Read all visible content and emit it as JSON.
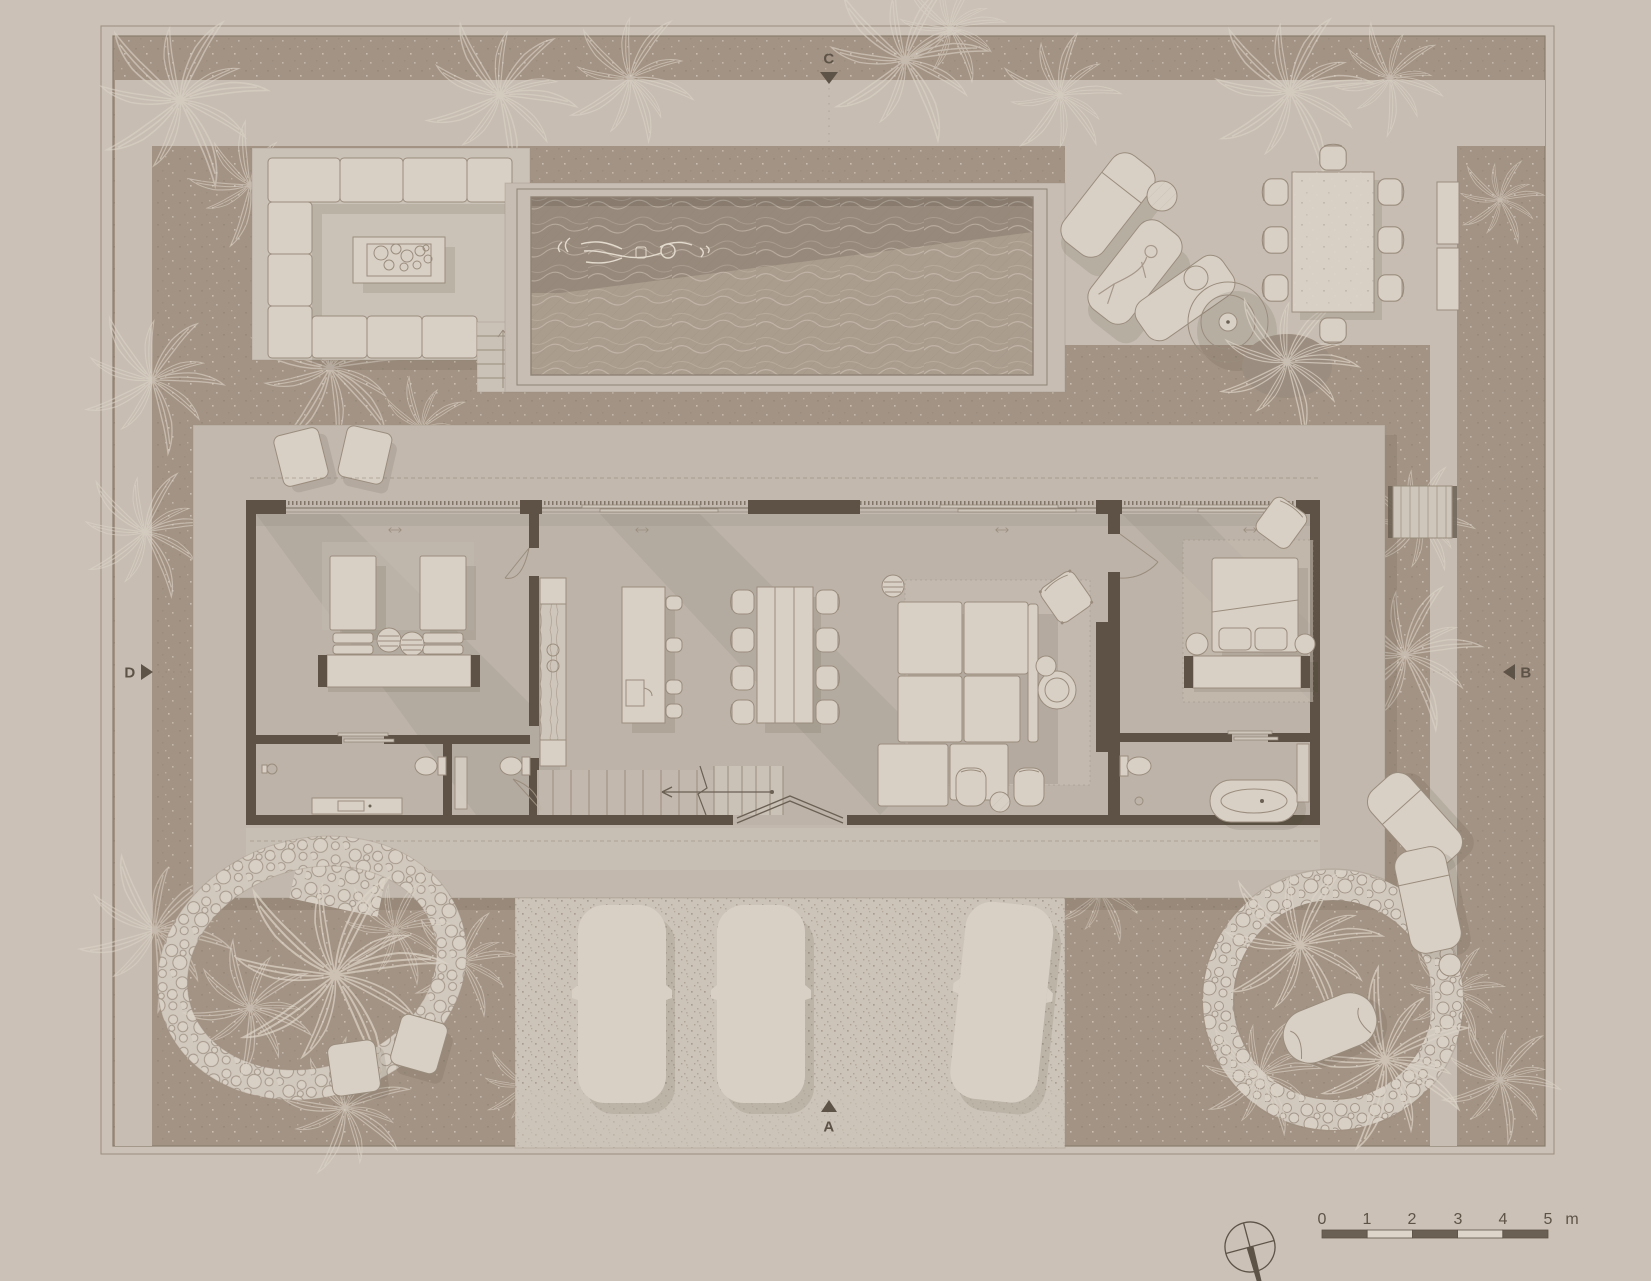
{
  "section_markers": {
    "top": "C",
    "bottom": "A",
    "left": "D",
    "right": "B"
  },
  "scale_bar": {
    "tick_labels": [
      "0",
      "1",
      "2",
      "3",
      "4",
      "5"
    ],
    "unit_label": "m"
  },
  "palette": {
    "page_bg": "#cbc1b6",
    "ground": "#a39384",
    "paving": "#c7bdb2",
    "platform": "#cbc2b7",
    "slab": "#c2b8ad",
    "floor": "#bdb3a8",
    "wall": "#5d5245",
    "furniture": "#d9d0c5",
    "furniture_line": "#9a8d7e",
    "pool_dark": "#97897b",
    "pool_light": "#ab9d8e",
    "driveway": "#cdc4b9",
    "pebble": "#d2c9be",
    "palm_line": "#ddd4c8",
    "ink": "#5e5347"
  },
  "features": [
    "site-boundary",
    "swimming-pool",
    "swimmer",
    "sunken-lounge-sofa",
    "coffee-table",
    "outdoor-stairs",
    "sun-loungers",
    "parasol",
    "outdoor-dining-set",
    "sideboard",
    "house-slab",
    "twin-bedroom",
    "twin-beds",
    "bedroom-bench",
    "shower",
    "toilet",
    "vanity",
    "kitchen-counter",
    "kitchen-island",
    "bar-stools",
    "indoor-dining-table",
    "dining-chairs",
    "staircase",
    "entry-pivot-door",
    "living-sofa",
    "rug",
    "armchair",
    "side-tables",
    "lounge-chairs",
    "master-bedroom",
    "double-bed",
    "bedside-tables",
    "freestanding-bathtub",
    "terrace-stools",
    "doormat-steps",
    "driveway",
    "cars",
    "pebble-pond",
    "garden-circle",
    "daybed",
    "palm-trees",
    "compass",
    "scale-bar",
    "section-markers"
  ]
}
